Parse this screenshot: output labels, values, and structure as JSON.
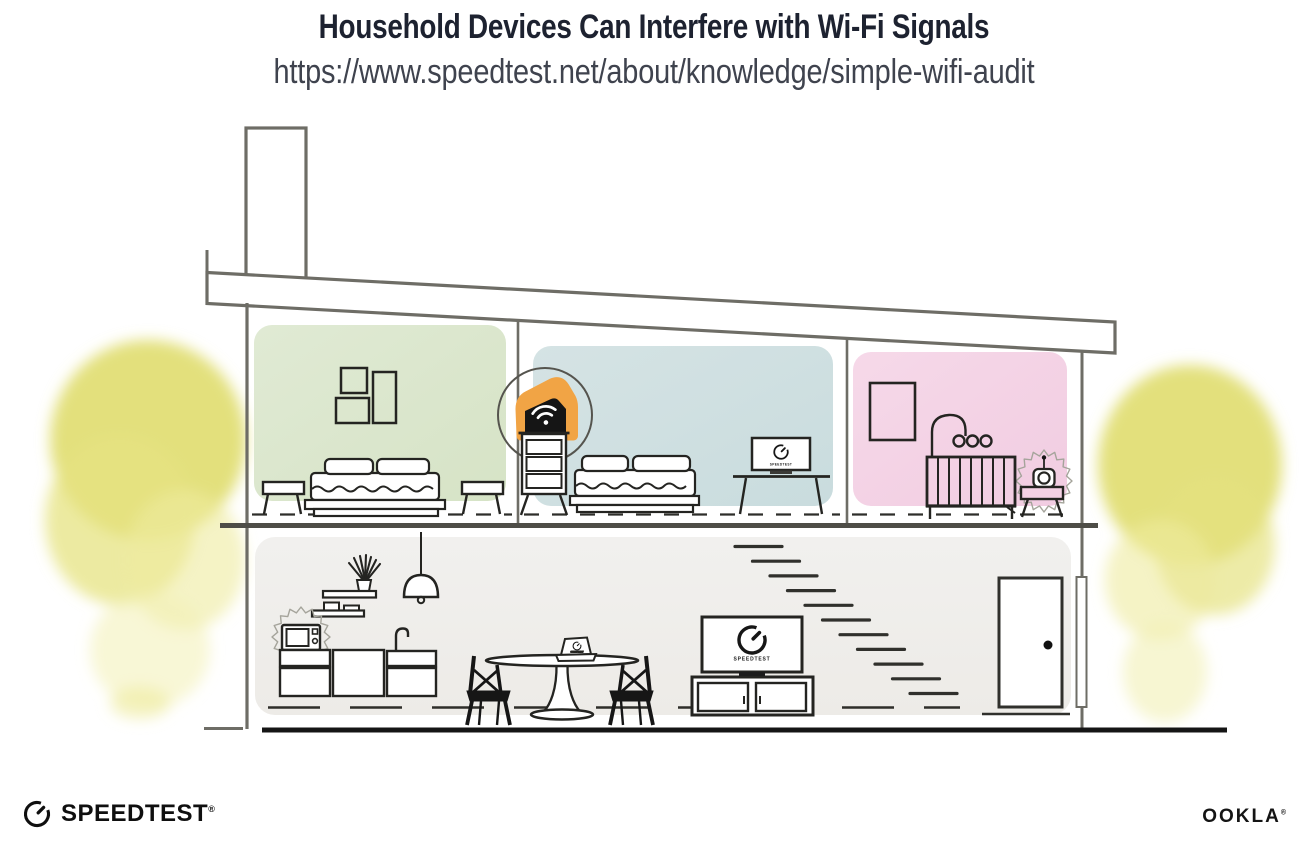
{
  "header": {
    "title": "Household Devices Can Interfere with Wi-Fi Signals",
    "subtitle_url": "https://www.speedtest.net/about/knowledge/simple-wifi-audit"
  },
  "illustration": {
    "screens": {
      "tv_label": "SPEEDTEST",
      "monitor_label": "SPEEDTEST",
      "laptop_label": "SPEEDTEST"
    },
    "icons": {
      "router": "wifi-router-icon",
      "wifi": "wifi-icon",
      "gauge": "speedtest-gauge-icon",
      "interference": "interference-burst-icon",
      "microwave": "microwave-icon",
      "baby_monitor": "baby-monitor-icon",
      "tree": "tree-icon"
    },
    "colors": {
      "accent_orange": "#f1a445",
      "room_green": "#dbe7cd",
      "room_blue": "#cddee0",
      "room_pink": "#f4d1e4",
      "room_gray": "#efeeea",
      "tree_yellow": "#e0dd6e",
      "structure_gray": "#6e6d66",
      "line_dark": "#1f1f1d",
      "title_navy": "#1d2230"
    }
  },
  "footer": {
    "speedtest_wordmark": "SPEEDTEST",
    "ookla_wordmark": "OOKLA",
    "registered_mark": "®"
  }
}
